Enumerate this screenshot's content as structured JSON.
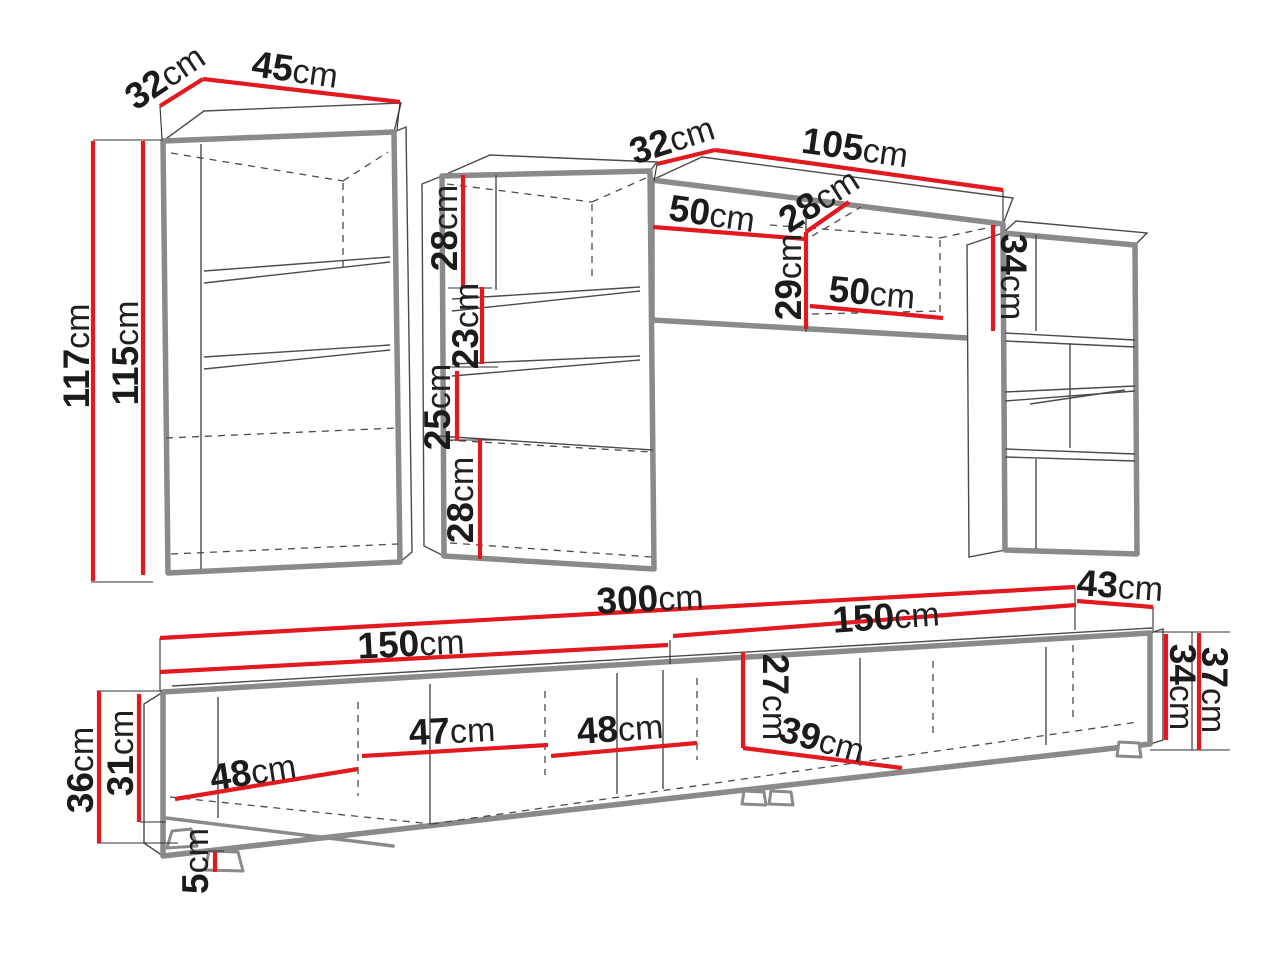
{
  "page": {
    "title": "Furniture wall unit dimension diagram",
    "background": "#ffffff"
  },
  "colors": {
    "dimension_red": "#e2191f",
    "outline_gray": "#8a8a8a",
    "detail_gray": "#4b4b4b",
    "label_text": "#1b1b1b"
  },
  "unit": "cm",
  "labels": {
    "left_depth": {
      "v": "32",
      "u": "cm"
    },
    "left_width": {
      "v": "45",
      "u": "cm"
    },
    "left_height_outer": {
      "v": "117",
      "u": "cm"
    },
    "left_height_inner": {
      "v": "115",
      "u": "cm"
    },
    "mid_sec1": {
      "v": "28",
      "u": "cm"
    },
    "mid_sec2": {
      "v": "23",
      "u": "cm"
    },
    "mid_sec3": {
      "v": "25",
      "u": "cm"
    },
    "mid_sec4": {
      "v": "28",
      "u": "cm"
    },
    "wall_depth": {
      "v": "32",
      "u": "cm"
    },
    "wall_width": {
      "v": "105",
      "u": "cm"
    },
    "wall_door1": {
      "v": "50",
      "u": "cm"
    },
    "wall_inner_depth": {
      "v": "28",
      "u": "cm"
    },
    "wall_inner_height": {
      "v": "29",
      "u": "cm"
    },
    "wall_door2": {
      "v": "50",
      "u": "cm"
    },
    "wall_height": {
      "v": "34",
      "u": "cm"
    },
    "stand_total_width": {
      "v": "300",
      "u": "cm"
    },
    "stand_left_width": {
      "v": "150",
      "u": "cm"
    },
    "stand_right_width": {
      "v": "150",
      "u": "cm"
    },
    "stand_depth": {
      "v": "43",
      "u": "cm"
    },
    "stand_height": {
      "v": "36",
      "u": "cm"
    },
    "stand_inner_height": {
      "v": "31",
      "u": "cm"
    },
    "stand_comp1": {
      "v": "48",
      "u": "cm"
    },
    "stand_comp2": {
      "v": "47",
      "u": "cm"
    },
    "stand_comp3": {
      "v": "48",
      "u": "cm"
    },
    "stand_inner_height2": {
      "v": "27",
      "u": "cm"
    },
    "stand_diag_depth": {
      "v": "39",
      "u": "cm"
    },
    "stand_body_height": {
      "v": "34",
      "u": "cm"
    },
    "stand_total_height": {
      "v": "37",
      "u": "cm"
    },
    "stand_foot_height": {
      "v": "5",
      "u": "cm"
    }
  }
}
